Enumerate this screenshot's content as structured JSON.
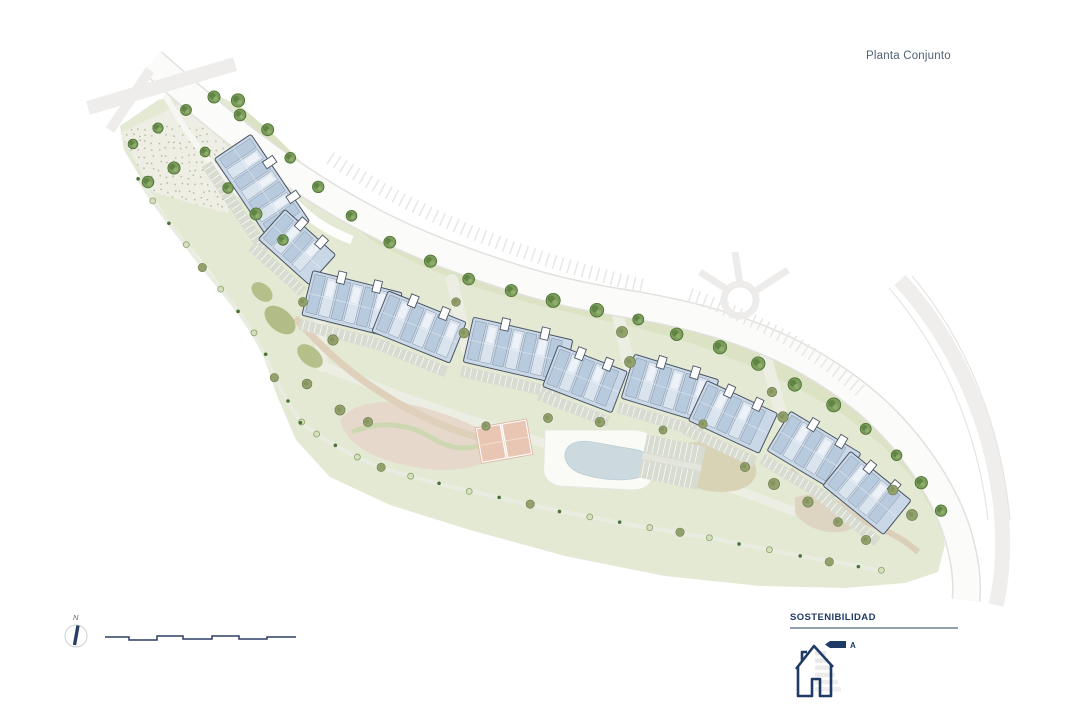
{
  "title": "Planta Conjunto",
  "compass": {
    "north_label": "N"
  },
  "legend": {
    "heading": "SOSTENIBILIDAD",
    "energy_rating": "A"
  },
  "palette": {
    "navy": "#1f3a66",
    "title_text": "#4f6378",
    "green_base": "#e4e9d3",
    "green_verge": "#dbe3c4",
    "tree_green": "#7b9c5b",
    "tree_dark": "#4a7031",
    "tree_olive": "#93a16c",
    "building_fill": "#c9d7e7",
    "building_unit_a": "#b7cade",
    "building_unit_b": "#d9e4ef",
    "building_outline": "#4a5563",
    "road_fill": "#fbfbfa",
    "road_edge": "#e2e1de",
    "path_light": "#eceee4",
    "parking_gray": "#d7dbd0",
    "pool_water": "#ccd9de",
    "court_clay": "#e9c6b4",
    "sand_tan": "#ddd2c0",
    "legend_rule": "#93a0b2",
    "bar_gray": "#e9e9e9"
  }
}
